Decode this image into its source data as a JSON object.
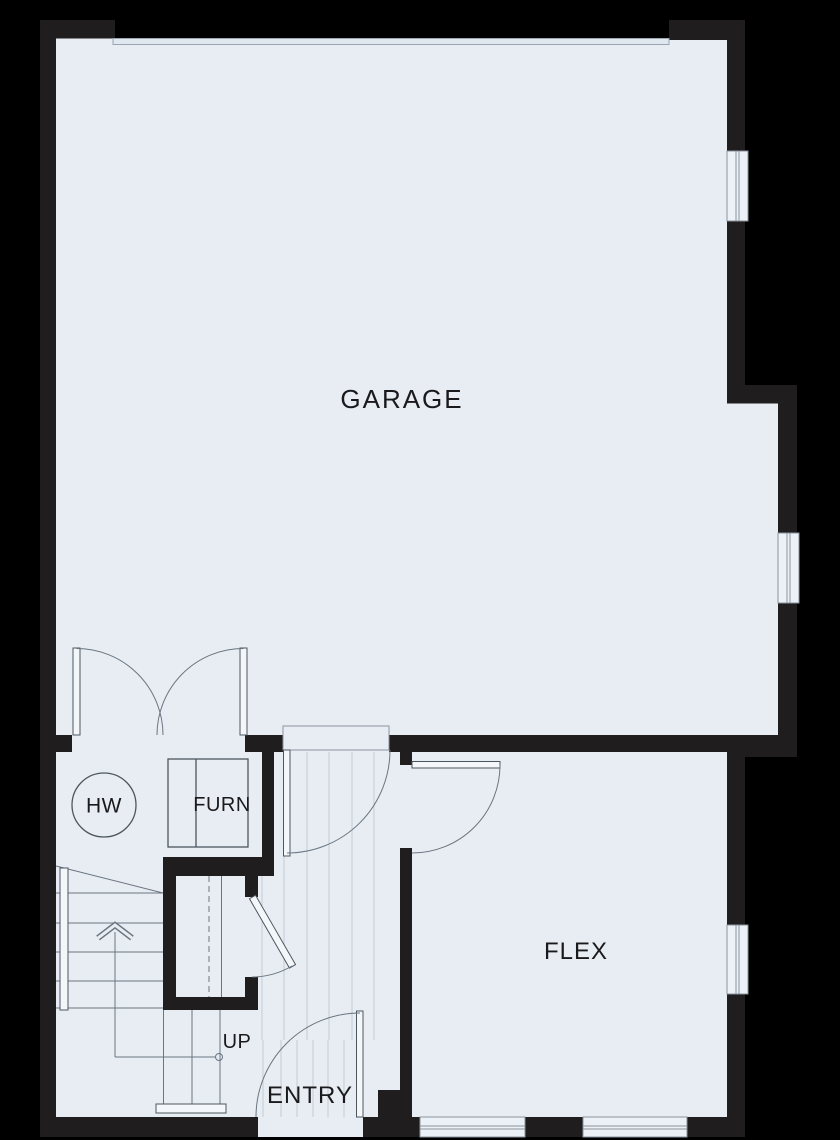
{
  "plan": {
    "labels": {
      "garage": "GARAGE",
      "flex": "FLEX",
      "entry": "ENTRY",
      "hot_water": "HW",
      "furnace": "FURN",
      "stairs_up": "UP"
    }
  },
  "colors": {
    "background": "#000000",
    "wall": "#1f1d1e",
    "floor": "#e8edf4",
    "line": "#6a7580",
    "detail": "#4c565f",
    "stripe": "#c3ccd4",
    "window_fill": "#ecf1f7",
    "window_stroke": "#8a939e",
    "door_leaf": "#f4f7fa",
    "garage_door_fill": "#dfe7ef",
    "garage_door_stroke": "#9aa5b1",
    "label": "#1a1a1d"
  }
}
